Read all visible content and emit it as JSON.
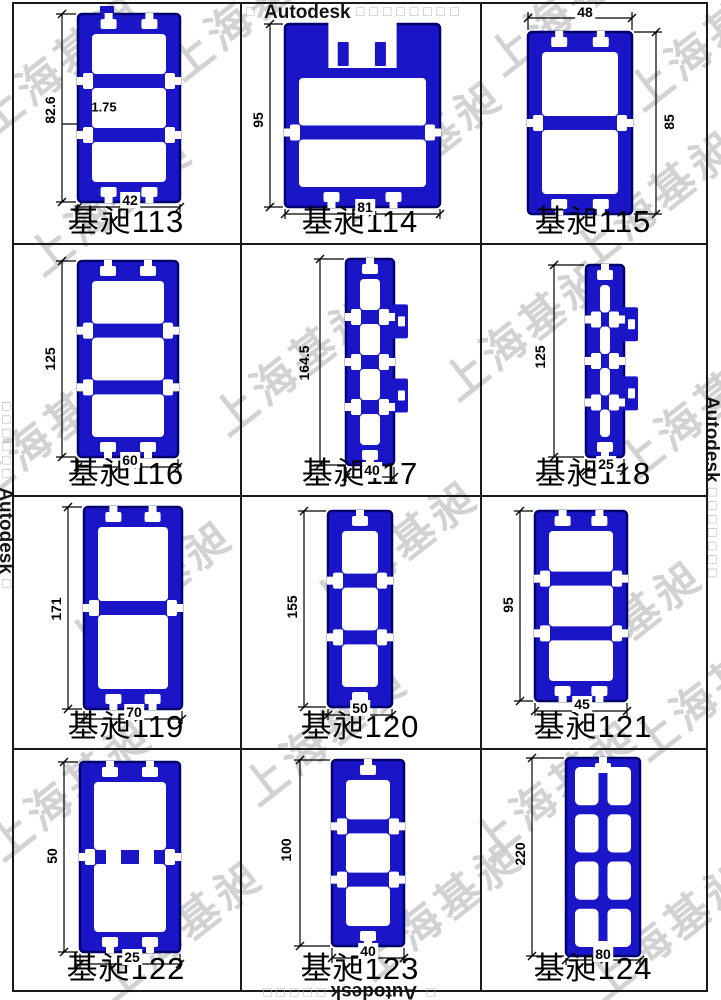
{
  "watermark": {
    "text": "上海基昶"
  },
  "colors": {
    "profile_fill": "#1b15c8",
    "profile_stroke": "#00006e",
    "dimension": "#000000",
    "watermark": "#cbcbcb"
  },
  "autodesk_stamps": {
    "top": {
      "prefix": "□",
      "label": "Autodesk",
      "suffix": "□□□□□□□□"
    },
    "right": {
      "prefix": "□",
      "label": "Autodesk",
      "suffix": "□□□□□□□"
    },
    "left": {
      "prefix": "□□□□□□",
      "label": "Autodesk",
      "suffix": "□"
    },
    "bottom": {
      "prefix": "□",
      "label": "Autodesk",
      "suffix": "□□□□□"
    }
  },
  "cells": [
    {
      "caption": "基昶113",
      "height": "82.6",
      "width": "42",
      "extra": "1.75"
    },
    {
      "caption": "基昶114",
      "height": "95",
      "width": "81"
    },
    {
      "caption": "基昶115",
      "height": "85",
      "width": "48"
    },
    {
      "caption": "基昶116",
      "height": "125",
      "width": "60"
    },
    {
      "caption": "基昶117",
      "height": "164.5",
      "width": "40"
    },
    {
      "caption": "基昶118",
      "height": "125",
      "width": "25"
    },
    {
      "caption": "基昶119",
      "height": "171",
      "width": "70"
    },
    {
      "caption": "基昶120",
      "height": "155",
      "width": "50"
    },
    {
      "caption": "基昶121",
      "height": "95",
      "width": "45"
    },
    {
      "caption": "基昶122",
      "height": "50",
      "width": "25"
    },
    {
      "caption": "基昶123",
      "height": "100",
      "width": "40"
    },
    {
      "caption": "基昶124",
      "height": "220",
      "width": "80"
    }
  ]
}
